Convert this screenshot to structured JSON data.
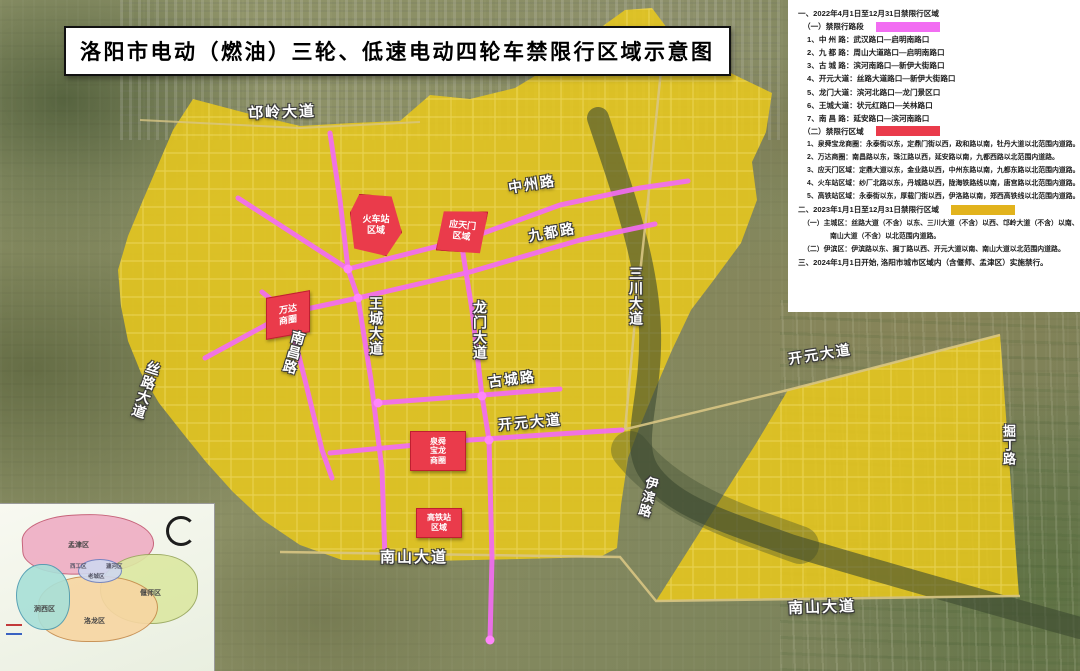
{
  "title": "洛阳市电动（燃油）三轮、低速电动四轮车禁限行区域示意图",
  "colors": {
    "restricted_road_2022_pink": "#f26df2",
    "restricted_area_2022_red": "#ea3b4b",
    "restricted_area_2023_yellow": "#e2b31d",
    "zone_fill_yellow": "#e7c71e"
  },
  "legend": {
    "swatch_styles": {
      "pink": "background:#f26df2",
      "red": "background:#ea3b4b",
      "yellow": "background:#e2b31d"
    },
    "lines": [
      {
        "text": "一、2022年4月1日至12月31日禁限行区域"
      },
      {
        "text": "（一）禁限行路段"
      },
      {
        "text": "1、中 州 路：武汉路口—启明南路口"
      },
      {
        "text": "2、九 都 路：周山大道路口—启明南路口"
      },
      {
        "text": "3、古 城 路：滨河南路口—新伊大街路口"
      },
      {
        "text": "4、开元大道：丝路大道路口—新伊大街路口"
      },
      {
        "text": "5、龙门大道：滨河北路口—龙门景区口"
      },
      {
        "text": "6、王城大道：状元红路口—关林路口"
      },
      {
        "text": "7、南 昌 路：延安路口—滨河南路口"
      },
      {
        "text": "（二）禁限行区域"
      },
      {
        "text": "1、泉舜宝龙商圈：永泰街以东，定鼎门街以西，政和路以南，牡丹大道以北范围内道路。"
      },
      {
        "text": "2、万达商圈：南昌路以东，珠江路以西，延安路以南，九都西路以北范围内道路。"
      },
      {
        "text": "3、应天门区域：定鼎大道以东，金业路以西，中州东路以南，九都东路以北范围内道路。"
      },
      {
        "text": "4、火车站区域：纱厂北路以东，丹城路以西，陇海铁路线以南，唐宫路以北范围内道路。"
      },
      {
        "text": "5、高铁站区域：永泰街以东，厚载门街以西，伊洛路以南，郑西高铁线以北范围内道路。"
      },
      {
        "text": "二、2023年1月1日至12月31日禁限行区域"
      },
      {
        "text": "（一）主城区：丝路大道（不含）以东、三川大道（不含）以西、邙岭大道（不含）以南、"
      },
      {
        "text": "南山大道（不含）以北范围内道路。"
      },
      {
        "text": "（二）伊滨区：伊滨路以东、掘丁路以西、开元大道以南、南山大道以北范围内道路。"
      },
      {
        "text": "三、2024年1月1日开始, 洛阳市城市区域内（含偃师、孟津区）实施禁行。"
      }
    ]
  },
  "map": {
    "road_labels": {
      "mangling": "邙岭大道",
      "zhongzhou": "中州路",
      "jiudu": "九都路",
      "sanchuan": "三川大道",
      "silu": "丝路大道",
      "wangcheng": "王城大道",
      "nanchang": "南昌路",
      "longmen": "龙门大道",
      "gucheng": "古城路",
      "kaiyuan": "开元大道",
      "nanshan": "南山大道",
      "yibin": "伊滨路",
      "kaiyuan_east": "开元大道",
      "jueding": "掘丁路",
      "nanshan_east": "南山大道"
    },
    "areas": {
      "railway_station": {
        "l1": "火车站",
        "l2": "区域"
      },
      "yingtianmen": {
        "l1": "应天门",
        "l2": "区域"
      },
      "wanda": {
        "l1": "万达",
        "l2": "商圈"
      },
      "quanshun_baolong": {
        "l1": "泉舜",
        "l2": "宝龙",
        "l3": "商圈"
      },
      "hsr_station": {
        "l1": "高铁站",
        "l2": "区域"
      }
    }
  },
  "inset": {
    "districts": {
      "mengjin": "孟津区",
      "yanshi": "偃师区",
      "luolong": "洛龙区",
      "jianxi": "涧西区",
      "xigong": "西工区",
      "laocheng": "老城区",
      "chanhe": "瀍河区"
    }
  }
}
